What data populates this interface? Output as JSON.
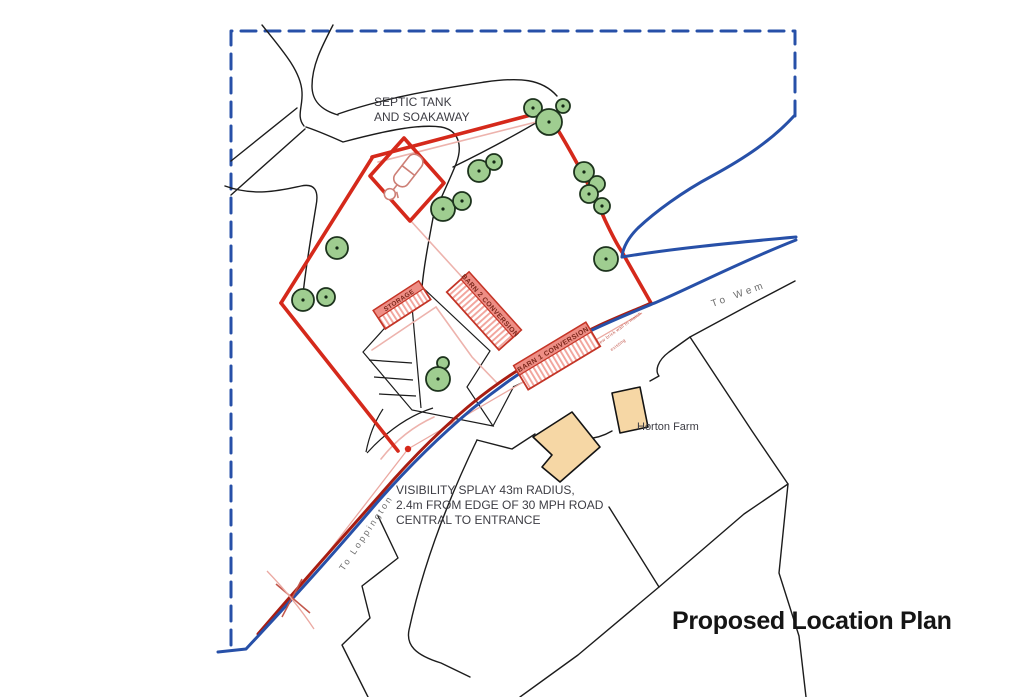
{
  "page_title": "Proposed Location Plan",
  "annotations": {
    "septic_tank": {
      "line1": "SEPTIC TANK",
      "line2": "AND SOAKAWAY"
    },
    "visibility_splay": {
      "line1": "VISIBILITY SPLAY 43m RADIUS,",
      "line2": "2.4m FROM EDGE OF 30 MPH ROAD",
      "line3": "CENTRAL TO ENTRANCE"
    },
    "horton_farm": "Horton Farm",
    "road_to_wem": "To Wem",
    "road_to_loppington": "To Loppington",
    "wall_note_line1": "new brick wall to match",
    "wall_note_line2": "existing"
  },
  "buildings": {
    "storage": "STORAGE",
    "barn1": "BARN 1 CONVERSION",
    "barn2": "BARN 2 CONVERSION"
  },
  "colors": {
    "boundary_red": "#d5291b",
    "road_red": "#a81d12",
    "map_blue": "#2750a8",
    "pink_line": "#edb3ad",
    "splay_pink": "#eba9a2",
    "splay_red": "#c2574b",
    "septic_pink": "#cd7f76",
    "building_fill": "#f7c3bd",
    "building_stripe": "#f2a49c",
    "building_band": "#ee8e85",
    "building_outline": "#c43527",
    "building_text": "#7c271b",
    "tree_fill": "#9fcd90",
    "tree_outline": "#1d331d",
    "farm_fill": "#f6d7a5",
    "black_line": "#1c1c1c",
    "label_dark": "#3d3d44",
    "label_gray": "#6e6e6e",
    "title_color": "#151515"
  }
}
